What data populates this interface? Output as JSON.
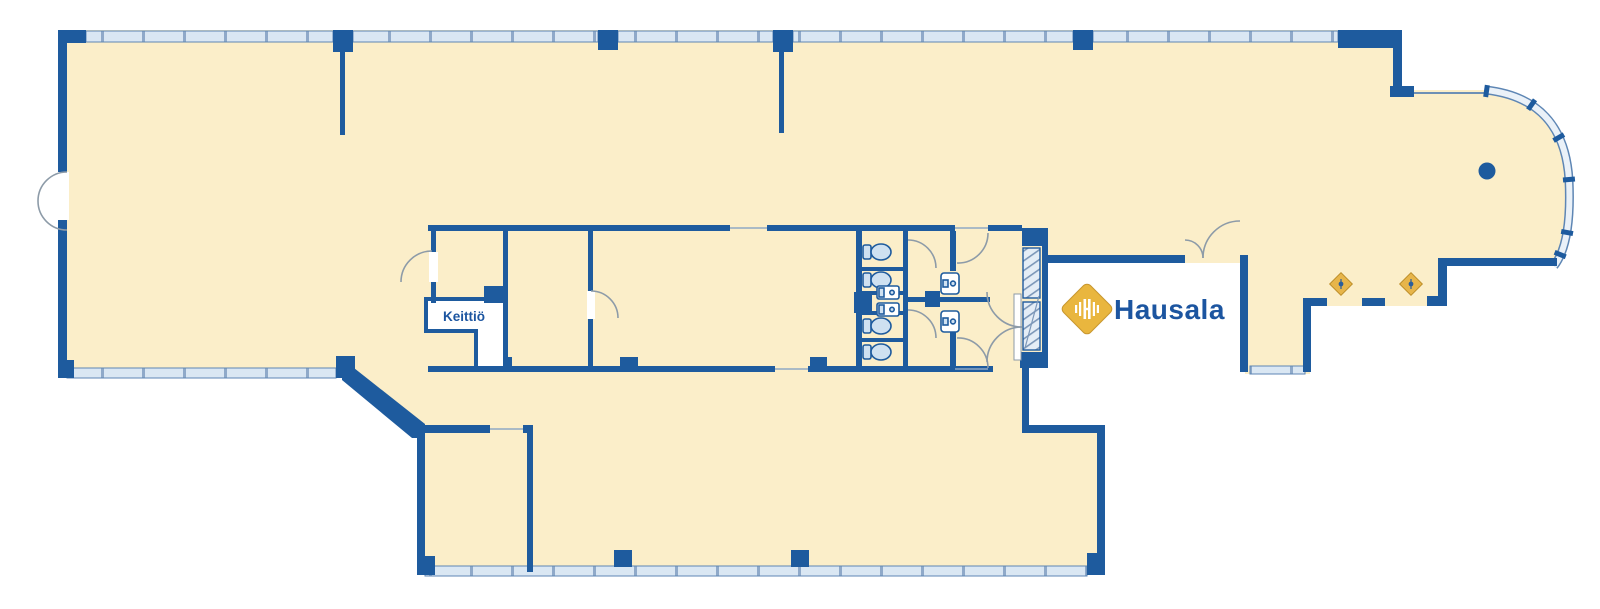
{
  "plan": {
    "kind": "office-floor-plan",
    "brand": "Hausala",
    "labels": {
      "kitchen": "Keittiö"
    },
    "fixtures": {
      "toilets": 4,
      "counter_sinks": 2,
      "wall_sinks": 2,
      "entrance_markers": 2,
      "structural_column_dot": 1
    },
    "colors": {
      "floor": "#FBEEC9",
      "wall": "#1E5B9E",
      "window_fill": "#DAE7F3",
      "window_line": "#5E86B4",
      "door_arc": "#8D9BA8",
      "fixture_fill": "#CFE1F1",
      "glass_fill": "#E4EDF6",
      "logo_gold": "#E9B63E",
      "logo_gold_border": "#C8972F",
      "logo_text": "#1C55A0"
    }
  }
}
